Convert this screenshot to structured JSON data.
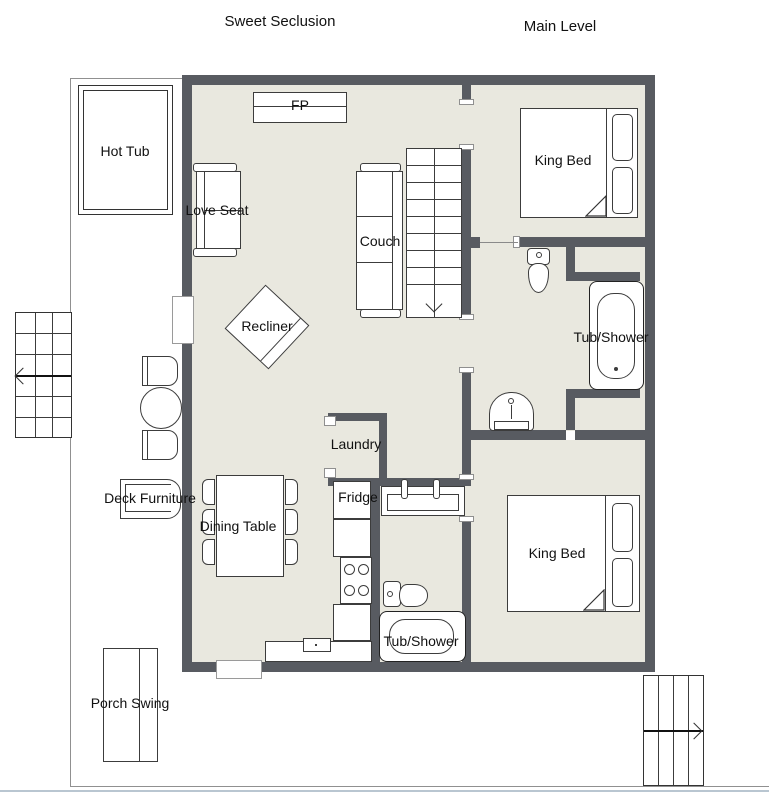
{
  "titles": {
    "left": "Sweet Seclusion",
    "right": "Main Level"
  },
  "labels": {
    "hot_tub": "Hot Tub",
    "love_seat": "Love Seat",
    "fireplace": "FP",
    "couch": "Couch",
    "king_bed_top": "King Bed",
    "tub_shower_top": "Tub/Shower",
    "recliner": "Recliner",
    "laundry": "Laundry",
    "fridge": "Fridge",
    "dining_table": "Dining Table",
    "deck_furniture": "Deck Furniture",
    "king_bed_bottom": "King Bed",
    "tub_shower_bottom": "Tub/Shower",
    "porch_swing": "Porch Swing"
  },
  "colors": {
    "wall": "#585b61",
    "floor": "#e9e8df",
    "deck_line": "#909090",
    "bottom_accent": "#b9c6d1",
    "outline": "#3c3c3c"
  }
}
